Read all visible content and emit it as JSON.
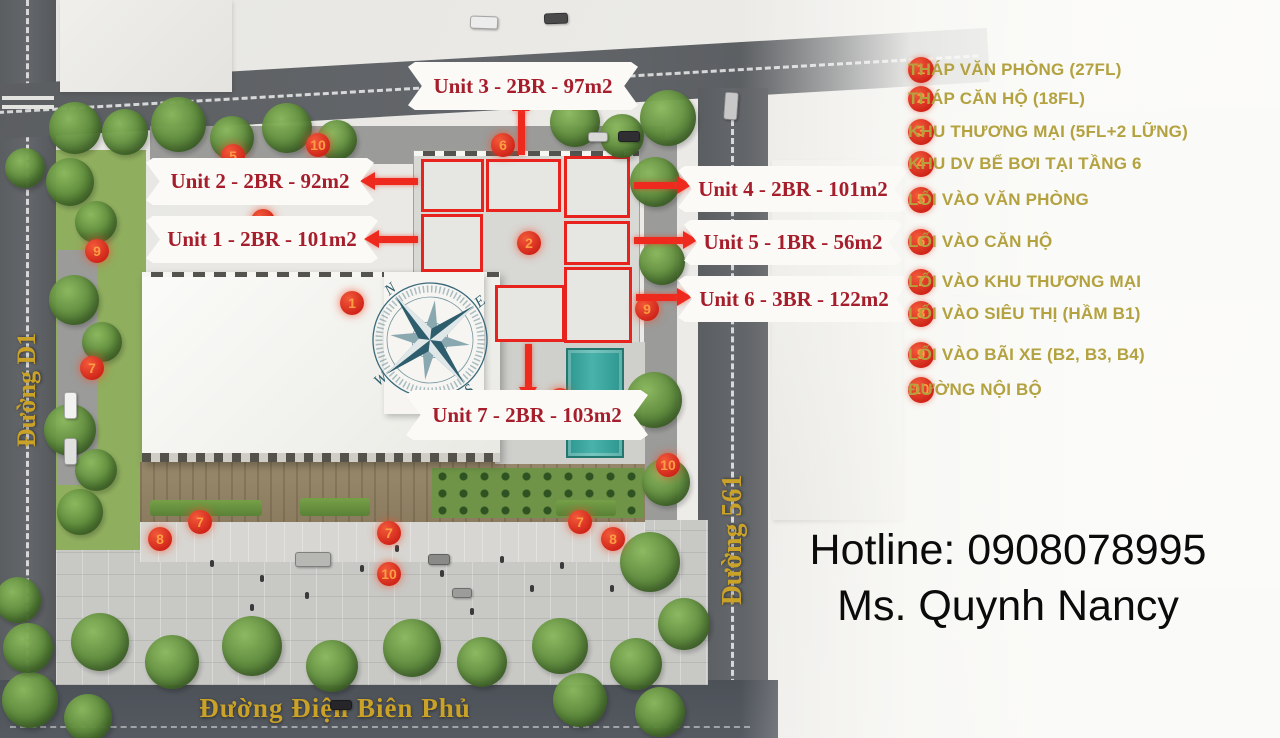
{
  "legend": {
    "items": [
      {
        "num": "1",
        "label": "THÁP VĂN PHÒNG (27FL)"
      },
      {
        "num": "2",
        "label": "THÁP CĂN HỘ (18FL)"
      },
      {
        "num": "3",
        "label": "KHU THƯƠNG MẠI (5FL+2 LỮNG)"
      },
      {
        "num": "4",
        "label": "KHU DV BỂ BƠI TẠI TẦNG 6"
      },
      {
        "num": "5",
        "label": "LỐI VÀO VĂN PHÒNG"
      },
      {
        "num": "6",
        "label": "LỐI VÀO CĂN HỘ"
      },
      {
        "num": "7",
        "label": "LỐI VÀO KHU THƯƠNG MẠI"
      },
      {
        "num": "8",
        "label": "LỐI VÀO SIÊU THỊ (HẦM B1)"
      },
      {
        "num": "9",
        "label": "LỐI VÀO BÃI XE (B2, B3, B4)"
      },
      {
        "num": "10",
        "label": "ĐƯỜNG NỘI BỘ"
      }
    ]
  },
  "plan": {
    "units": [
      {
        "id": "unit-1",
        "label": "Unit 1 - 2BR - 101m2",
        "x": 146,
        "y": 216,
        "w": 232,
        "h": 47,
        "arrow": {
          "dir": "left",
          "x": 378,
          "y": 239,
          "len": 40
        }
      },
      {
        "id": "unit-2",
        "label": "Unit 2 - 2BR - 92m2",
        "x": 146,
        "y": 158,
        "w": 228,
        "h": 47,
        "arrow": {
          "dir": "left",
          "x": 374,
          "y": 181,
          "len": 44
        }
      },
      {
        "id": "unit-3",
        "label": "Unit 3 - 2BR - 97m2",
        "x": 408,
        "y": 62,
        "w": 230,
        "h": 48,
        "arrow": {
          "dir": "up",
          "x": 521,
          "y": 110,
          "len": 45
        }
      },
      {
        "id": "unit-4",
        "label": "Unit 4 - 2BR - 101m2",
        "x": 678,
        "y": 166,
        "w": 230,
        "h": 46,
        "arrow": {
          "dir": "right",
          "x": 634,
          "y": 185,
          "len": 44
        }
      },
      {
        "id": "unit-5",
        "label": "Unit 5 - 1BR - 56m2",
        "x": 684,
        "y": 220,
        "w": 218,
        "h": 45,
        "arrow": {
          "dir": "right",
          "x": 634,
          "y": 240,
          "len": 50
        }
      },
      {
        "id": "unit-6",
        "label": "Unit 6 - 3BR - 122m2",
        "x": 678,
        "y": 276,
        "w": 232,
        "h": 46,
        "arrow": {
          "dir": "right",
          "x": 636,
          "y": 297,
          "len": 42
        }
      },
      {
        "id": "unit-7",
        "label": "Unit 7 - 2BR - 103m2",
        "x": 406,
        "y": 390,
        "w": 242,
        "h": 50,
        "arrow": {
          "dir": "down",
          "x": 528,
          "y": 344,
          "len": 44
        }
      }
    ],
    "markers": [
      {
        "num": "10",
        "x": 318,
        "y": 145
      },
      {
        "num": "6",
        "x": 503,
        "y": 145
      },
      {
        "num": "5",
        "x": 233,
        "y": 156,
        "hidden": true
      },
      {
        "num": "3",
        "x": 263,
        "y": 221,
        "hidden": true
      },
      {
        "num": "9",
        "x": 97,
        "y": 251
      },
      {
        "num": "1",
        "x": 352,
        "y": 303
      },
      {
        "num": "2",
        "x": 529,
        "y": 243
      },
      {
        "num": "9",
        "x": 647,
        "y": 309
      },
      {
        "num": "7",
        "x": 92,
        "y": 368
      },
      {
        "num": "4",
        "x": 560,
        "y": 400,
        "hidden": true
      },
      {
        "num": "10",
        "x": 668,
        "y": 465
      },
      {
        "num": "7",
        "x": 200,
        "y": 522
      },
      {
        "num": "8",
        "x": 160,
        "y": 539
      },
      {
        "num": "7",
        "x": 389,
        "y": 533
      },
      {
        "num": "10",
        "x": 389,
        "y": 574
      },
      {
        "num": "7",
        "x": 580,
        "y": 522
      },
      {
        "num": "8",
        "x": 613,
        "y": 539
      }
    ]
  },
  "streets": {
    "left": "Đường D1",
    "right": "Đường 561",
    "bottom": "Đường Điện Biên Phủ"
  },
  "compass": {
    "n": "N",
    "e": "E",
    "s": "S",
    "w": "W"
  },
  "contact": {
    "hotline": "Hotline: 0908078995",
    "agent": "Ms. Quynh Nancy"
  },
  "colors": {
    "marker_num": "#ff9d42",
    "banner_text": "#a61e2b",
    "legend_text": "#b3a23f",
    "street_label": "#c9a227",
    "arrow": "#ee2a1f",
    "pool": "#3aa79e"
  }
}
